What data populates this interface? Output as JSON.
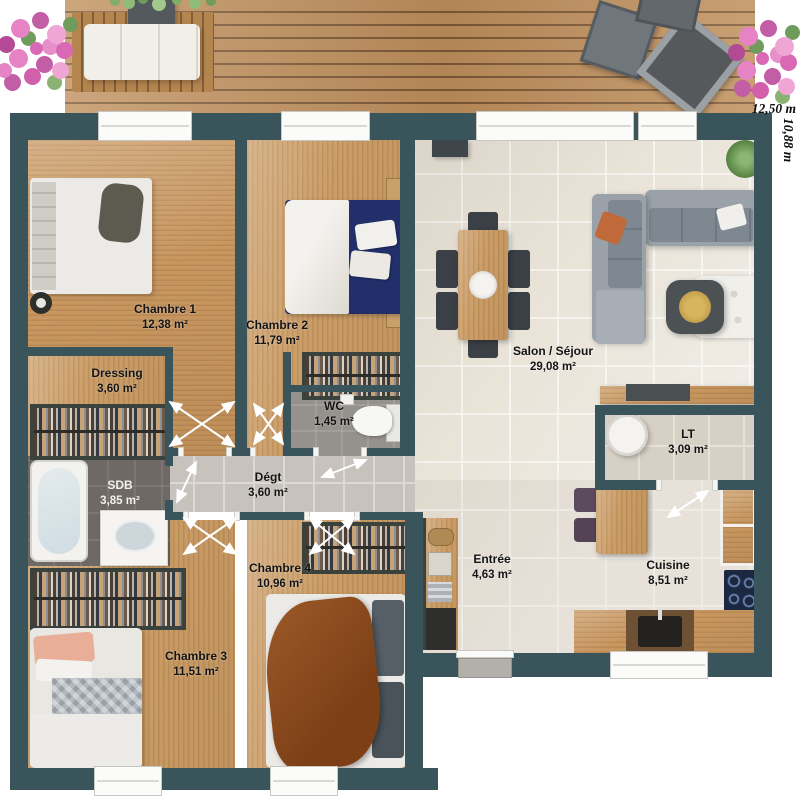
{
  "plan": {
    "title": "Plan de maison de plain-pied",
    "rooms": [
      {
        "id": "chambre1",
        "name": "Chambre 1",
        "area": "12,38 m²"
      },
      {
        "id": "chambre2",
        "name": "Chambre 2",
        "area": "11,79 m²"
      },
      {
        "id": "dressing",
        "name": "Dressing",
        "area": "3,60 m²"
      },
      {
        "id": "wc",
        "name": "WC",
        "area": "1,45 m²"
      },
      {
        "id": "sdb",
        "name": "SDB",
        "area": "3,85 m²"
      },
      {
        "id": "degt",
        "name": "Dégt",
        "area": "3,60 m²"
      },
      {
        "id": "chambre4",
        "name": "Chambre 4",
        "area": "10,96 m²"
      },
      {
        "id": "chambre3",
        "name": "Chambre 3",
        "area": "11,51 m²"
      },
      {
        "id": "salon",
        "name": "Salon / Séjour",
        "area": "29,08 m²"
      },
      {
        "id": "lt",
        "name": "LT",
        "area": "3,09 m²"
      },
      {
        "id": "entree",
        "name": "Entrée",
        "area": "4,63 m²"
      },
      {
        "id": "cuisine",
        "name": "Cuisine",
        "area": "8,51 m²"
      }
    ],
    "dimensions": {
      "width_label": "12,50 m",
      "height_label": "10,88 m"
    },
    "colors": {
      "wall": "#3a545c",
      "wood_floor": "#cb9d66",
      "tile_floor": "#e9e3d8",
      "deck": "#bf8f5c",
      "bed_navy": "#21306b",
      "bed_brown": "#8a4a1f",
      "flowers_pink": "#d969b5"
    }
  }
}
